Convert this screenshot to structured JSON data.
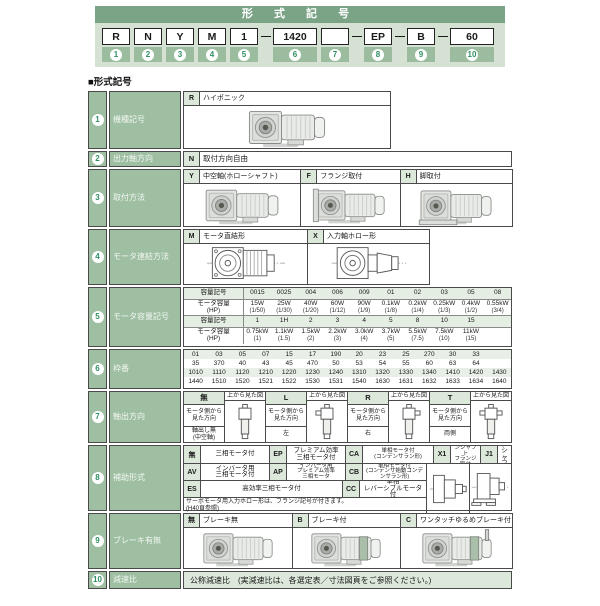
{
  "header": {
    "title": "形 式 記 号",
    "dash": "—",
    "sequence": [
      {
        "code": "R",
        "num": "1"
      },
      {
        "code": "N",
        "num": "2"
      },
      {
        "code": "Y",
        "num": "3"
      },
      {
        "code": "M",
        "num": "4"
      },
      {
        "code": "1",
        "num": "5"
      },
      {
        "dash": true
      },
      {
        "code": "1420",
        "num": "6",
        "wide": true
      },
      {
        "code": "",
        "num": "7"
      },
      {
        "dash": true
      },
      {
        "code": "EP",
        "num": "8"
      },
      {
        "dash": true
      },
      {
        "code": "B",
        "num": "9"
      },
      {
        "dash": true
      },
      {
        "code": "60",
        "num": "10",
        "wide": true
      }
    ]
  },
  "section_heading": "■形式記号",
  "rows": {
    "r1": {
      "num": "1",
      "label": "機種記号",
      "options": [
        {
          "code": "R",
          "desc": "ハイポニック",
          "img": "hyponic-gearmotor-photo"
        }
      ]
    },
    "r2": {
      "num": "2",
      "label": "出力軸方向",
      "code": "N",
      "desc": "取付方向自由"
    },
    "r3": {
      "num": "3",
      "label": "取付方法",
      "options": [
        {
          "code": "Y",
          "desc": "中空軸(ホローシャフト)",
          "img": "hollow-shaft-photo"
        },
        {
          "code": "F",
          "desc": "フランジ取付",
          "img": "flange-mount-photo"
        },
        {
          "code": "H",
          "desc": "脚取付",
          "img": "foot-mount-photo"
        }
      ]
    },
    "r4": {
      "num": "4",
      "label": "モータ連結方法",
      "options": [
        {
          "code": "M",
          "desc": "モータ直結形",
          "img": "motor-direct-drawing"
        },
        {
          "code": "X",
          "desc": "入力軸ホロー形",
          "img": "input-hollow-drawing"
        }
      ]
    },
    "r5": {
      "num": "5",
      "label": "モータ容量記号",
      "code_label": "容量記号",
      "cap_label": "モータ容量\n(HP)",
      "codes1": [
        "0015",
        "0025",
        "004",
        "006",
        "009",
        "01",
        "02",
        "03",
        "05",
        "08"
      ],
      "kw1": [
        "15W",
        "25W",
        "40W",
        "60W",
        "90W",
        "0.1kW",
        "0.2kW",
        "0.25kW",
        "0.4kW",
        "0.55kW"
      ],
      "hp1": [
        "(1/50)",
        "(1/30)",
        "(1/20)",
        "(1/12)",
        "(1/9)",
        "(1/8)",
        "(1/4)",
        "(1/3)",
        "(1/2)",
        "(3/4)"
      ],
      "codes2": [
        "1",
        "1H",
        "2",
        "3",
        "4",
        "5",
        "8",
        "10",
        "15",
        ""
      ],
      "kw2": [
        "0.75kW",
        "1.1kW",
        "1.5kW",
        "2.2kW",
        "3.0kW",
        "3.7kW",
        "5.5kW",
        "7.5kW",
        "11kW",
        ""
      ],
      "hp2": [
        "(1)",
        "(1.5)",
        "(2)",
        "(3)",
        "(4)",
        "(5)",
        "(7.5)",
        "(10)",
        "(15)",
        ""
      ]
    },
    "r6": {
      "num": "6",
      "label": "枠番",
      "grid": [
        [
          "01",
          "03",
          "05",
          "07",
          "15",
          "17",
          "190",
          "20",
          "23",
          "25",
          "270",
          "30",
          "33",
          ""
        ],
        [
          "35",
          "370",
          "40",
          "43",
          "45",
          "470",
          "50",
          "53",
          "54",
          "55",
          "60",
          "63",
          "64",
          ""
        ],
        [
          "1010",
          "1110",
          "1120",
          "1210",
          "1220",
          "1230",
          "1240",
          "1310",
          "1320",
          "1330",
          "1340",
          "1410",
          "1420",
          "1430"
        ],
        [
          "1440",
          "1510",
          "1520",
          "1521",
          "1522",
          "1530",
          "1531",
          "1540",
          "1630",
          "1631",
          "1632",
          "1633",
          "1634",
          "1640"
        ]
      ]
    },
    "r7": {
      "num": "7",
      "label": "軸出方向",
      "top_view": "上から見た図",
      "view_from": "モータ側から\n見た方向",
      "groups": [
        {
          "code": "無",
          "dir": "軸出し無\n(中空軸)",
          "img": "topview-no-shaft"
        },
        {
          "code": "L",
          "dir": "左",
          "img": "topview-left-shaft"
        },
        {
          "code": "R",
          "dir": "右",
          "img": "topview-right-shaft"
        },
        {
          "code": "T",
          "dir": "両側",
          "img": "topview-both-shafts"
        }
      ]
    },
    "r8": {
      "num": "8",
      "label": "補助形式",
      "row_a": [
        {
          "code": "無",
          "desc": "三相モータ付"
        },
        {
          "code": "EP",
          "desc": "プレミアム効率\n三相モータ付"
        },
        {
          "code": "CA",
          "desc": "単相モータ付\n(コンデンサラン形)"
        },
        {
          "code": "X1",
          "desc": "プラグインシャフト\nフランジ取付"
        },
        {
          "code": "J1",
          "desc": "プラグインシャフト\n脚取付"
        }
      ],
      "row_b": [
        {
          "code": "AV",
          "desc": "インバータ用\n三相モータ付"
        },
        {
          "code": "AP",
          "desc": "インバータ用\nプレミアム効率\n三相モータ"
        },
        {
          "code": "CB",
          "desc": "単相モータ付\n(コンデンサ始動コンデンサラン形)"
        }
      ],
      "row_c": [
        {
          "code": "ES",
          "desc": "高効率三相モータ付"
        },
        {
          "code": "CC",
          "desc": "単相\nレバーシブルモータ付"
        }
      ],
      "note": "サーボモータ用入力ホロー形は、フランジ記号が付きます。\n(H40頁参照)",
      "drawings": [
        "plug-in-shaft-flange-drawing",
        "plug-in-shaft-foot-drawing"
      ]
    },
    "r9": {
      "num": "9",
      "label": "ブレーキ有無",
      "options": [
        {
          "code": "無",
          "desc": "ブレーキ無",
          "img": "brake-none-photo"
        },
        {
          "code": "B",
          "desc": "ブレーキ付",
          "img": "brake-photo"
        },
        {
          "code": "C",
          "desc": "ワンタッチゆるめブレーキ付",
          "img": "one-touch-release-brake-photo"
        }
      ]
    },
    "r10": {
      "num": "10",
      "label": "減速比",
      "desc": "公称減速比　(実減速比は、各選定表／寸法図頁をご参照ください。)"
    }
  }
}
